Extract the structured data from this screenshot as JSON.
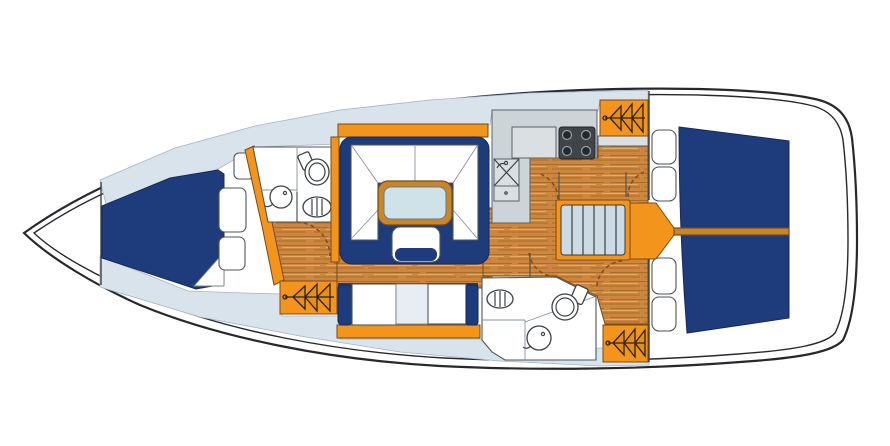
{
  "diagram": {
    "type": "yacht-interior-floorplan",
    "view": "top-down deck plan of a sailing yacht",
    "components": [
      {
        "id": "hull",
        "label": "Hull outline with double sheer line"
      },
      {
        "id": "v-berth",
        "label": "Forward cabin V-berth"
      },
      {
        "id": "forward-head",
        "label": "Forward head with toilet, oval basin and round sink"
      },
      {
        "id": "saloon-settee",
        "label": "U-shaped saloon settee"
      },
      {
        "id": "saloon-table",
        "label": "Saloon table with stool"
      },
      {
        "id": "port-settee",
        "label": "Straight port settee"
      },
      {
        "id": "galley",
        "label": "Galley with counter, 4-burner stove, sink and drawers"
      },
      {
        "id": "companionway-steps",
        "label": "Companionway steps with engine box"
      },
      {
        "id": "aft-berth",
        "label": "Aft cabin double berth"
      },
      {
        "id": "aft-head",
        "label": "Aft head with toilet, oval basin and round sink"
      },
      {
        "id": "hanging-locker-forward",
        "label": "Hanging locker (port forward)"
      },
      {
        "id": "hanging-locker-galley",
        "label": "Hanging locker (aft of galley)"
      },
      {
        "id": "hanging-locker-aft",
        "label": "Hanging locker (port aft)"
      },
      {
        "id": "side-shelves",
        "label": "Side shelf cushions"
      }
    ]
  },
  "colors": {
    "hull_outline": "#26282b",
    "deck_band": "#d9e3ec",
    "berth_navy": "#1e3c7c",
    "joinery_orange": "#f3941c",
    "wood_floor": "#cd8640",
    "wood_grain_dark": "#a96d29",
    "wood_grain_light": "#e3aa63",
    "wood_trim": "#c8862c",
    "table_top": "#cfe1e9",
    "counter_grey": "#cdd4d8",
    "counter_light": "#dadfe2",
    "stove_dark": "#3f4549",
    "tread_blue": "#ccdae3",
    "settee_mid_panel": "#e7edf2",
    "door_arc": "#8a4a1f",
    "fixture_outline": "#3c4247"
  }
}
